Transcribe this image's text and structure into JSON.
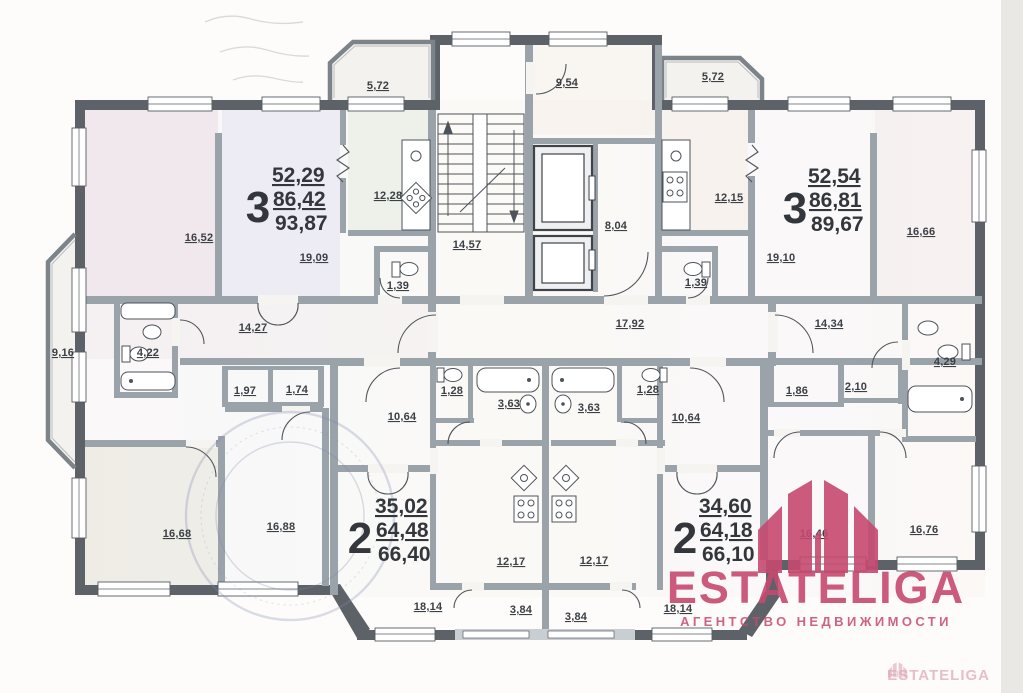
{
  "plan": {
    "apartments": [
      {
        "id": "apt-3-left",
        "number": "3",
        "areas": [
          "52,29",
          "86,42",
          "93,87"
        ]
      },
      {
        "id": "apt-3-right",
        "number": "3",
        "areas": [
          "52,54",
          "86,81",
          "89,67"
        ]
      },
      {
        "id": "apt-2-left",
        "number": "2",
        "areas": [
          "35,02",
          "64,48",
          "66,40"
        ]
      },
      {
        "id": "apt-2-right",
        "number": "2",
        "areas": [
          "34,60",
          "64,18",
          "66,10"
        ]
      }
    ],
    "rooms": {
      "balcony_top_left": "5,72",
      "room_9_54": "9,54",
      "balcony_top_right": "5,72",
      "room_16_52": "16,52",
      "kitchen_12_28": "12,28",
      "living_19_09": "19,09",
      "wc_left_1_39": "1,39",
      "hall_14_27": "14,27",
      "bath_4_22": "4,22",
      "balcony_9_16": "9,16",
      "closet_1_97": "1,97",
      "closet_1_74": "1,74",
      "stairs_14_57": "14,57",
      "lift_hall_8_04": "8,04",
      "corridor_17_92": "17,92",
      "wc_1_28_l": "1,28",
      "bath_3_63_l": "3,63",
      "bath_3_63_r": "3,63",
      "wc_1_28_r": "1,28",
      "hall_10_64_l": "10,64",
      "hall_10_64_r": "10,64",
      "kitchen_12_15": "12,15",
      "living_19_10": "19,10",
      "room_16_66": "16,66",
      "wc_right_1_39": "1,39",
      "hall_14_34": "14,34",
      "closet_1_86": "1,86",
      "closet_2_10": "2,10",
      "bath_4_29": "4,29",
      "room_16_68": "16,68",
      "room_16_88": "16,88",
      "kitchen_12_17_l": "12,17",
      "kitchen_12_17_r": "12,17",
      "room_18_14_l": "18,14",
      "balcony_3_84_l": "3,84",
      "balcony_3_84_r": "3,84",
      "room_18_14_r": "18,14",
      "room_16_46": "16,46",
      "room_16_76": "16,76"
    },
    "watermark": {
      "brand": "ESTATELIGA",
      "tagline": "АГЕНТСТВО НЕДВИЖИМОСТИ",
      "corner": "ESTATELIGA",
      "color": "#c64a70"
    }
  }
}
